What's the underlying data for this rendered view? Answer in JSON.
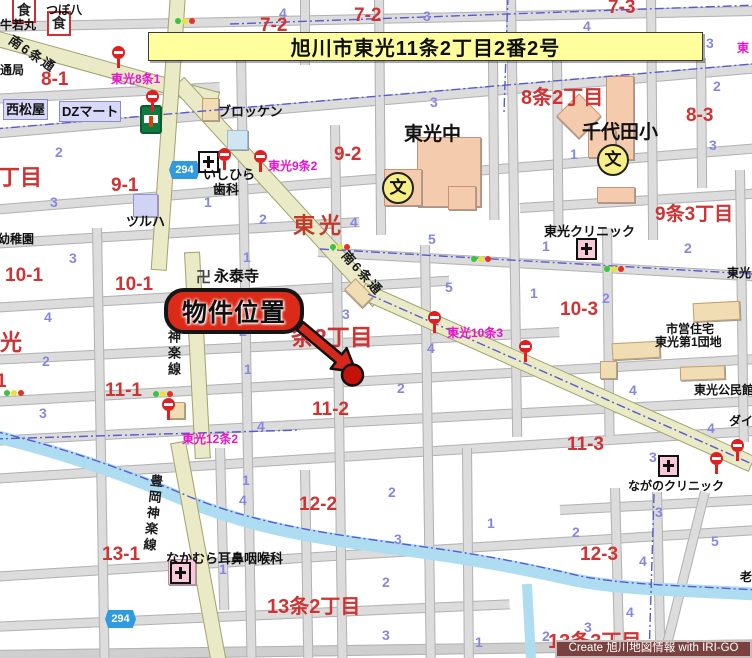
{
  "banner": {
    "text": "旭川市東光11条2丁目2番2号"
  },
  "marker": {
    "label": "物件位置"
  },
  "credit": {
    "text": "Create 旭川地図情報 with IRI-GO"
  },
  "road_names": {
    "minami6_upper": "南6条通",
    "minami6_lower": "南6条通",
    "kagura": "神楽線",
    "toyooka_kagura": "豊岡神楽線",
    "route294": "294"
  },
  "toko_road_label": "東光",
  "schools": {
    "toko_chu": "東光中",
    "chiyoda_sho": "千代田小"
  },
  "temple": {
    "name": "永泰寺"
  },
  "icons": {
    "school_mark": "文",
    "temple_mark": "卍",
    "restaurant_mark": "食"
  },
  "shops": {
    "tsuboya": "つぼ八",
    "ushiwakamaru": "牛若丸",
    "nishimatsuya": "西松屋",
    "dz_mart": "DZマート",
    "brocken": "ブロッケン",
    "tsuruha": "ツルハ"
  },
  "medical": {
    "ishihira_line1": "いしひら",
    "ishihira_line2": "歯科",
    "toko_clinic": "東光クリニック",
    "nagano_clinic": "ながのクリニック",
    "nakamura_ent": "なかむら耳鼻咽喉科"
  },
  "public": {
    "shiei_jutaku": "市営住宅",
    "toko_danchi": "東光第1団地",
    "kominkan": "東光公民館"
  },
  "partial_labels": {
    "tsukyoku": "通局",
    "yochien": "幼稚園",
    "chome": "丁目",
    "hikari": "光",
    "one": "1",
    "toko_right": "東光",
    "dai": "ダイ",
    "rou": "老"
  },
  "colors": {
    "banner_bg": "#ffff9e",
    "marker_red": "#dc2a18",
    "block_red": "#cf3333",
    "lot_blue": "#8787e2",
    "bus_magenta": "#e714c9",
    "road_yellow": "#eaeac6",
    "river_blue": "#aedcf0",
    "credit_bg": "#7a4141"
  },
  "red_blocks": [
    {
      "t": "7-2",
      "x": 260,
      "y": 15
    },
    {
      "t": "7-2",
      "x": 354,
      "y": 5
    },
    {
      "t": "7-3",
      "x": 608,
      "y": -3
    },
    {
      "t": "8-1",
      "x": 41,
      "y": 69
    },
    {
      "t": "8-3",
      "x": 686,
      "y": 105
    },
    {
      "t": "9-1",
      "x": 111,
      "y": 175
    },
    {
      "t": "9-2",
      "x": 334,
      "y": 144
    },
    {
      "t": "10-1",
      "x": 5,
      "y": 265
    },
    {
      "t": "10-1",
      "x": 115,
      "y": 274
    },
    {
      "t": "10-3",
      "x": 560,
      "y": 299
    },
    {
      "t": "11-1",
      "x": 105,
      "y": 380
    },
    {
      "t": "11-2",
      "x": 312,
      "y": 399
    },
    {
      "t": "11-3",
      "x": 567,
      "y": 434
    },
    {
      "t": "12-2",
      "x": 299,
      "y": 494
    },
    {
      "t": "12-3",
      "x": 580,
      "y": 544
    },
    {
      "t": "13-1",
      "x": 102,
      "y": 544
    }
  ],
  "chome_big": [
    {
      "t": "8条2丁目",
      "x": 521,
      "y": 81,
      "fs": 20
    },
    {
      "t": "9条3丁目",
      "x": 655,
      "y": 199,
      "fs": 19
    },
    {
      "t": "条2丁目",
      "x": 291,
      "y": 318,
      "fs": 23
    },
    {
      "t": "13条2丁目",
      "x": 267,
      "y": 590,
      "fs": 20
    },
    {
      "t": "13条3丁目",
      "x": 548,
      "y": 625,
      "fs": 20
    },
    {
      "t": "丁目",
      "x": -2,
      "y": 160,
      "fs": 22
    }
  ],
  "bus_labels": [
    {
      "t": "東光8条1",
      "x": 111,
      "y": 70
    },
    {
      "t": "東光9条2",
      "x": 268,
      "y": 157
    },
    {
      "t": "東光10条3",
      "x": 447,
      "y": 324
    },
    {
      "t": "東光12条2",
      "x": 182,
      "y": 430
    },
    {
      "t": "東",
      "x": 737,
      "y": 39
    }
  ],
  "lot_numbers": [
    {
      "t": "4",
      "x": 279,
      "y": 5
    },
    {
      "t": "3",
      "x": 423,
      "y": 8
    },
    {
      "t": "4",
      "x": 583,
      "y": 18
    },
    {
      "t": "3",
      "x": 706,
      "y": 35
    },
    {
      "t": "2",
      "x": 713,
      "y": 78
    },
    {
      "t": "3",
      "x": 430,
      "y": 94
    },
    {
      "t": "3",
      "x": 709,
      "y": 137
    },
    {
      "t": "1",
      "x": 570,
      "y": 146
    },
    {
      "t": "2",
      "x": 55,
      "y": 144
    },
    {
      "t": "3",
      "x": 50,
      "y": 194
    },
    {
      "t": "1",
      "x": 204,
      "y": 194
    },
    {
      "t": "2",
      "x": 259,
      "y": 211
    },
    {
      "t": "4",
      "x": 350,
      "y": 214
    },
    {
      "t": "5",
      "x": 428,
      "y": 231
    },
    {
      "t": "1",
      "x": 243,
      "y": 249
    },
    {
      "t": "3",
      "x": 69,
      "y": 250
    },
    {
      "t": "1",
      "x": 542,
      "y": 238
    },
    {
      "t": "2",
      "x": 684,
      "y": 240
    },
    {
      "t": "5",
      "x": 445,
      "y": 279
    },
    {
      "t": "1",
      "x": 530,
      "y": 285
    },
    {
      "t": "2",
      "x": 602,
      "y": 290
    },
    {
      "t": "3",
      "x": 342,
      "y": 306
    },
    {
      "t": "4",
      "x": 44,
      "y": 309
    },
    {
      "t": "2",
      "x": 239,
      "y": 323
    },
    {
      "t": "4",
      "x": 427,
      "y": 340
    },
    {
      "t": "2",
      "x": 42,
      "y": 353
    },
    {
      "t": "1",
      "x": 244,
      "y": 361
    },
    {
      "t": "2",
      "x": 397,
      "y": 380
    },
    {
      "t": "4",
      "x": 629,
      "y": 382
    },
    {
      "t": "3",
      "x": 39,
      "y": 405
    },
    {
      "t": "4",
      "x": 257,
      "y": 418
    },
    {
      "t": "4",
      "x": 707,
      "y": 420
    },
    {
      "t": "3",
      "x": 649,
      "y": 449
    },
    {
      "t": "1",
      "x": 242,
      "y": 472
    },
    {
      "t": "4",
      "x": 239,
      "y": 492
    },
    {
      "t": "2",
      "x": 388,
      "y": 484
    },
    {
      "t": "1",
      "x": 487,
      "y": 515
    },
    {
      "t": "2",
      "x": 572,
      "y": 524
    },
    {
      "t": "3",
      "x": 655,
      "y": 504
    },
    {
      "t": "5",
      "x": 711,
      "y": 533
    },
    {
      "t": "3",
      "x": 394,
      "y": 531
    },
    {
      "t": "4",
      "x": 639,
      "y": 553
    },
    {
      "t": "1",
      "x": 219,
      "y": 561
    },
    {
      "t": "2",
      "x": 382,
      "y": 574
    },
    {
      "t": "4",
      "x": 626,
      "y": 604
    },
    {
      "t": "3",
      "x": 584,
      "y": 619
    },
    {
      "t": "3",
      "x": 382,
      "y": 627
    },
    {
      "t": "2",
      "x": 542,
      "y": 628
    },
    {
      "t": "1",
      "x": 475,
      "y": 634
    }
  ],
  "signals": [
    {
      "x": 175,
      "y": 18
    },
    {
      "x": 330,
      "y": 244
    },
    {
      "x": 471,
      "y": 256
    },
    {
      "x": 604,
      "y": 266
    },
    {
      "x": 153,
      "y": 391
    },
    {
      "x": 4,
      "y": 390
    }
  ],
  "bus_stops": [
    {
      "x": 112,
      "y": 46
    },
    {
      "x": 146,
      "y": 90
    },
    {
      "x": 218,
      "y": 148
    },
    {
      "x": 254,
      "y": 150
    },
    {
      "x": 428,
      "y": 311
    },
    {
      "x": 519,
      "y": 340
    },
    {
      "x": 162,
      "y": 398
    },
    {
      "x": 710,
      "y": 452
    },
    {
      "x": 731,
      "y": 439
    }
  ]
}
